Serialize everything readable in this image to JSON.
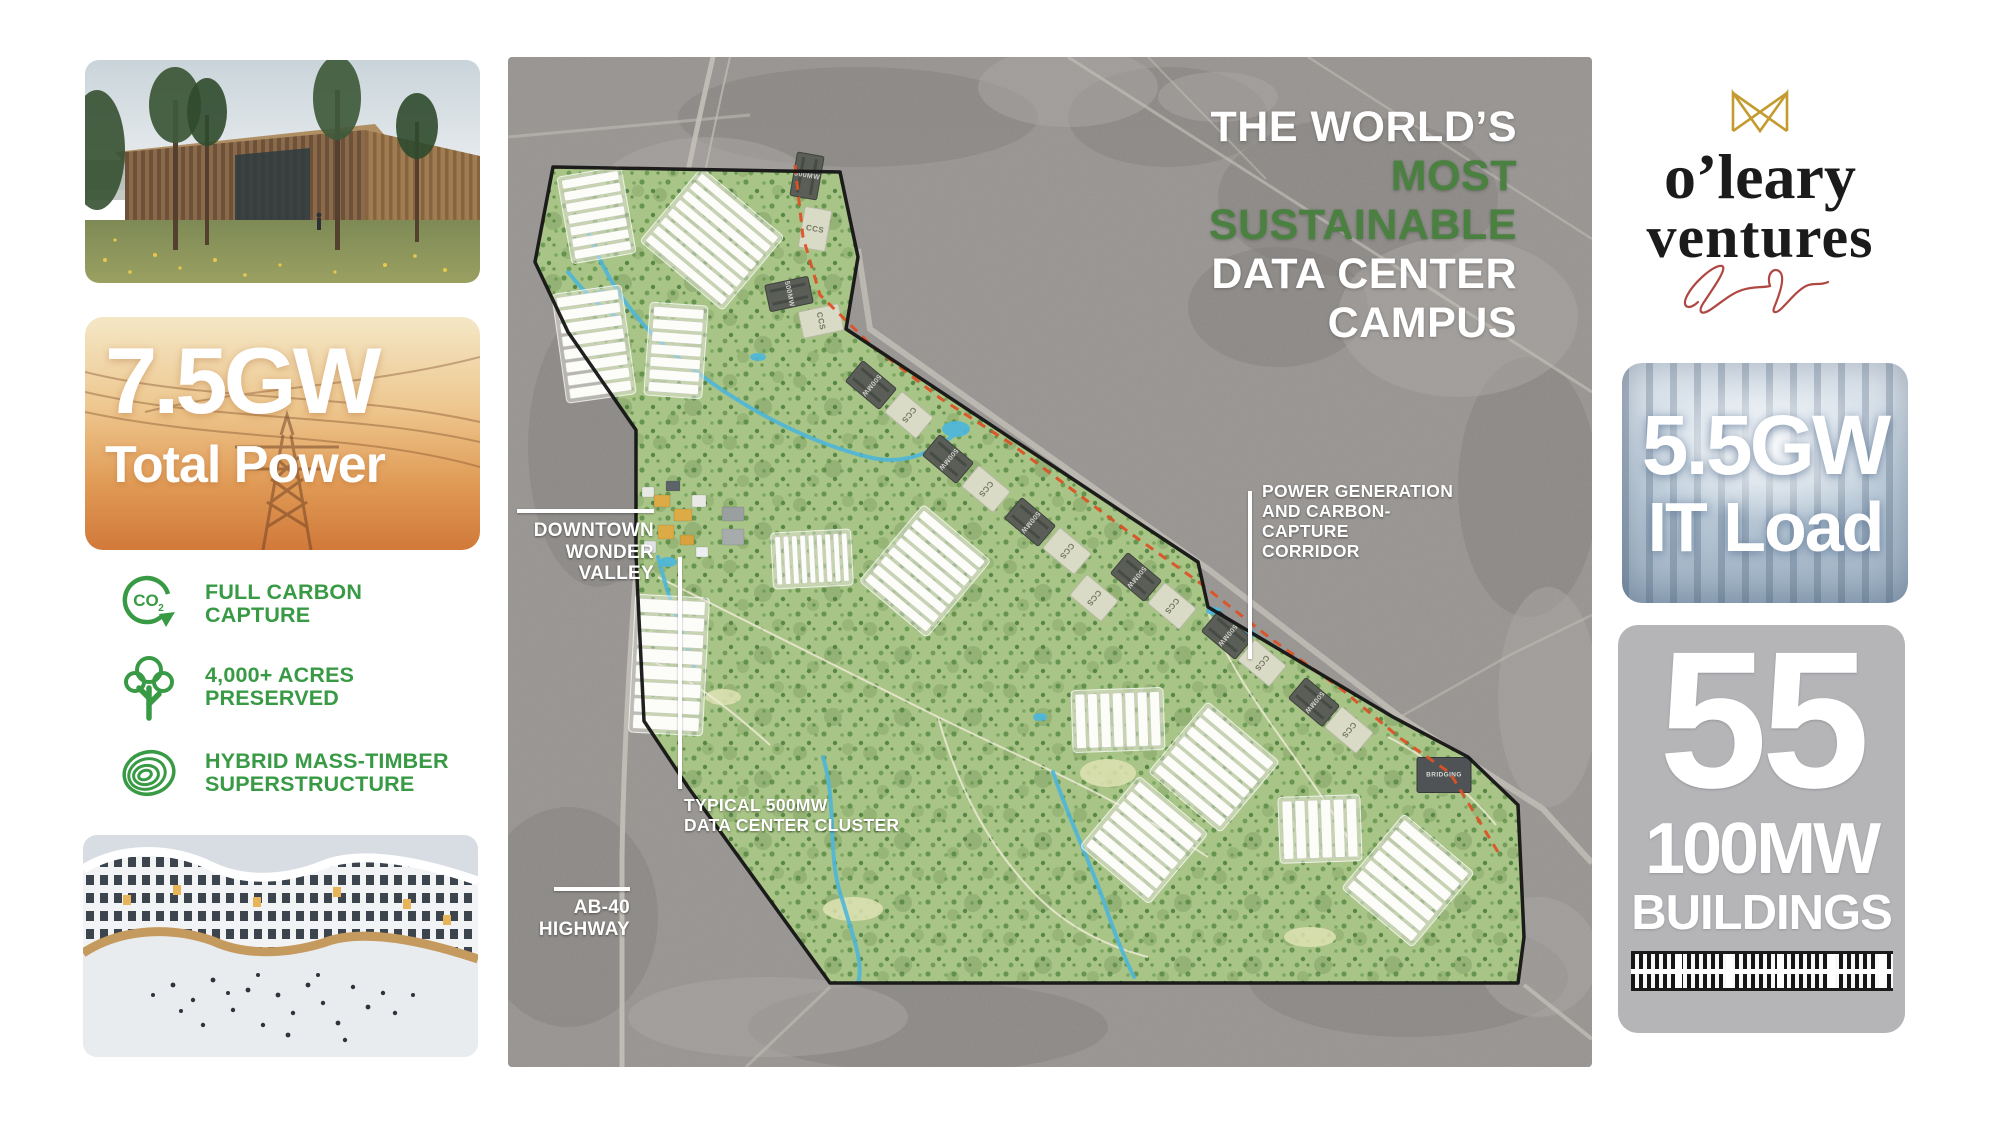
{
  "colors": {
    "title_white": "#ffffff",
    "title_green": "#4a8040",
    "feature_green": "#389a44",
    "map_green": "#a9c487",
    "map_gray": "#908d8a",
    "corridor_red": "#dc5226",
    "campus_outline": "#141414",
    "gold": "#c49b2e",
    "signature_red": "#a93832",
    "buildings_card_gray": "#b5b5b8"
  },
  "left_column": {
    "photo_top": "timber-datacenter-rendering",
    "power_card": {
      "value": "7.5GW",
      "label": "Total Power"
    },
    "features": [
      {
        "icon": "co2-capture-icon",
        "line1": "FULL CARBON",
        "line2": "CAPTURE"
      },
      {
        "icon": "tree-icon",
        "line1": "4,000+ ACRES",
        "line2": "PRESERVED"
      },
      {
        "icon": "timber-rings-icon",
        "line1": "HYBRID MASS-TIMBER",
        "line2": "SUPERSTRUCTURE"
      }
    ],
    "photo_bottom": "winter-plaza-rendering"
  },
  "map": {
    "title": {
      "line1": "THE WORLD’S",
      "line2": "MOST",
      "line3": "SUSTAINABLE",
      "line4": "DATA CENTER",
      "line5": "CAMPUS"
    },
    "labels": {
      "downtown_1": "DOWNTOWN",
      "downtown_2": "WONDER",
      "downtown_3": "VALLEY",
      "cluster_1": "TYPICAL 500MW",
      "cluster_2": "DATA CENTER CLUSTER",
      "highway_1": "AB-40",
      "highway_2": "HIGHWAY",
      "corridor_1": "POWER GENERATION",
      "corridor_2": "AND CARBON-CAPTURE",
      "corridor_3": "CORRIDOR"
    },
    "building_labels": {
      "dark": "500MW",
      "light": "CCS",
      "bridging": "BRIDGING"
    },
    "geo": {
      "polygon": "45,110 332,115 350,200 338,272 690,505 700,550 885,660 960,700 1010,748 1016,880 1010,926 322,926 180,730 136,664 128,500 128,373 60,275 27,205",
      "clusters": [
        {
          "x": 60,
          "y": 118,
          "w": 57,
          "h": 80,
          "rot": -10,
          "bars": 7,
          "dir": "h"
        },
        {
          "x": 55,
          "y": 236,
          "w": 62,
          "h": 102,
          "rot": -8,
          "bars": 8,
          "dir": "h"
        },
        {
          "x": 154,
          "y": 138,
          "w": 100,
          "h": 88,
          "rot": 40,
          "bars": 8,
          "dir": "h"
        },
        {
          "x": 143,
          "y": 251,
          "w": 50,
          "h": 85,
          "rot": 4,
          "bars": 7,
          "dir": "h"
        },
        {
          "x": 268,
          "y": 478,
          "w": 72,
          "h": 48,
          "rot": -3,
          "bars": 9,
          "dir": "v"
        },
        {
          "x": 128,
          "y": 543,
          "w": 66,
          "h": 130,
          "rot": 3,
          "bars": 8,
          "dir": "h"
        },
        {
          "x": 377,
          "y": 468,
          "w": 80,
          "h": 92,
          "rot": 40,
          "bars": 8,
          "dir": "h"
        },
        {
          "x": 568,
          "y": 636,
          "w": 84,
          "h": 54,
          "rot": -2,
          "bars": 7,
          "dir": "v"
        },
        {
          "x": 663,
          "y": 668,
          "w": 86,
          "h": 84,
          "rot": 40,
          "bars": 7,
          "dir": "h"
        },
        {
          "x": 595,
          "y": 741,
          "w": 82,
          "h": 84,
          "rot": 40,
          "bars": 7,
          "dir": "h"
        },
        {
          "x": 775,
          "y": 743,
          "w": 74,
          "h": 58,
          "rot": -2,
          "bars": 6,
          "dir": "v"
        },
        {
          "x": 858,
          "y": 779,
          "w": 84,
          "h": 89,
          "rot": 40,
          "bars": 7,
          "dir": "h"
        }
      ],
      "corridor_path": "M287,108 L295,180 L312,238 L362,287 L432,341 L502,386 L562,431 L622,476 L692,526 L762,581 L832,631 L892,681 L942,716 L990,795",
      "buildings": [
        {
          "cx": 299,
          "cy": 119,
          "rot": -80,
          "type": "dark"
        },
        {
          "cx": 307,
          "cy": 172,
          "rot": -80,
          "type": "light"
        },
        {
          "cx": 281,
          "cy": 237,
          "rot": -12,
          "type": "dark"
        },
        {
          "cx": 313,
          "cy": 264,
          "rot": -12,
          "type": "light"
        },
        {
          "cx": 363,
          "cy": 328,
          "rot": 40,
          "type": "dark"
        },
        {
          "cx": 401,
          "cy": 358,
          "rot": 40,
          "type": "light"
        },
        {
          "cx": 440,
          "cy": 402,
          "rot": 40,
          "type": "dark"
        },
        {
          "cx": 478,
          "cy": 432,
          "rot": 40,
          "type": "light"
        },
        {
          "cx": 522,
          "cy": 465,
          "rot": 40,
          "type": "dark"
        },
        {
          "cx": 559,
          "cy": 494,
          "rot": 40,
          "type": "light"
        },
        {
          "cx": 586,
          "cy": 541,
          "rot": 40,
          "type": "light"
        },
        {
          "cx": 628,
          "cy": 520,
          "rot": 40,
          "type": "dark"
        },
        {
          "cx": 664,
          "cy": 549,
          "rot": 40,
          "type": "light"
        },
        {
          "cx": 719,
          "cy": 578,
          "rot": 40,
          "type": "dark"
        },
        {
          "cx": 754,
          "cy": 606,
          "rot": 40,
          "type": "light"
        },
        {
          "cx": 806,
          "cy": 645,
          "rot": 40,
          "type": "dark"
        },
        {
          "cx": 841,
          "cy": 673,
          "rot": 40,
          "type": "light"
        },
        {
          "cx": 936,
          "cy": 718,
          "rot": 0,
          "type": "bridging"
        }
      ],
      "streams": [
        "M78,170 C95,215 120,260 170,300 C230,350 300,385 360,400 C400,410 428,392 446,378",
        "M315,700 C330,750 318,800 335,845 C345,880 356,906 350,926",
        "M545,715 C560,760 580,800 596,845 C606,875 616,900 626,920",
        "M150,500 C160,540 174,575 186,610",
        "M60,215 C80,240 95,252 112,262"
      ],
      "ponds": [
        [
          448,
          372,
          14,
          8
        ],
        [
          95,
          238,
          9,
          5
        ],
        [
          160,
          505,
          9,
          5
        ],
        [
          250,
          300,
          8,
          4
        ],
        [
          706,
          554,
          8,
          4
        ],
        [
          742,
          577,
          6,
          4
        ],
        [
          532,
          660,
          7,
          4
        ]
      ],
      "meadows": [
        [
          600,
          716,
          28,
          14
        ],
        [
          345,
          852,
          30,
          12
        ],
        [
          802,
          880,
          26,
          10
        ],
        [
          215,
          640,
          18,
          8
        ]
      ],
      "trails": [
        "M150,520 C240,565 330,610 420,655 C510,700 600,735 700,800",
        "M700,555 C720,610 758,660 790,705 C810,735 830,760 850,800",
        "M430,660 C450,730 480,790 530,840 C560,870 600,890 640,900",
        "M136,600 C180,620 220,650 262,688",
        "M880,680 C920,700 958,732 988,768"
      ],
      "roads": [
        {
          "d": "M205,0 C175,130 148,270 140,370 C132,460 117,620 114,800 L114,1010",
          "w": 5,
          "o": 0.9
        },
        {
          "d": "M222,0 C192,130 166,270 158,370",
          "w": 2,
          "o": 0.7
        },
        {
          "d": "M350,192 L362,272 L700,512 L892,660 L1035,752 L1084,806",
          "w": 6,
          "o": 0.8
        },
        {
          "d": "M560,0 L1084,335",
          "w": 3,
          "o": 0.65
        },
        {
          "d": "M800,0 L1084,182",
          "w": 2.5,
          "o": 0.55
        },
        {
          "d": "M640,0 L758,122",
          "w": 2,
          "o": 0.5
        },
        {
          "d": "M1016,928 L1084,982",
          "w": 4,
          "o": 0.75
        },
        {
          "d": "M322,930 L238,1010",
          "w": 3,
          "o": 0.55
        },
        {
          "d": "M0,80 L242,58",
          "w": 3,
          "o": 0.55
        },
        {
          "d": "M892,660 L1002,598 L1084,558",
          "w": 2.5,
          "o": 0.5
        }
      ],
      "patches_dark": [
        [
          350,
          60,
          180,
          50
        ],
        [
          90,
          390,
          70,
          140
        ],
        [
          850,
          140,
          140,
          80
        ],
        [
          1020,
          430,
          70,
          130
        ],
        [
          900,
          920,
          160,
          60
        ],
        [
          420,
          970,
          180,
          45
        ],
        [
          60,
          860,
          90,
          110
        ],
        [
          660,
          60,
          100,
          50
        ],
        [
          770,
          250,
          90,
          60
        ]
      ],
      "patches_light": [
        [
          200,
          150,
          120,
          70
        ],
        [
          950,
          260,
          120,
          80
        ],
        [
          1040,
          640,
          50,
          110
        ],
        [
          260,
          960,
          140,
          40
        ],
        [
          1030,
          900,
          60,
          60
        ],
        [
          560,
          30,
          90,
          40
        ],
        [
          710,
          40,
          60,
          25
        ]
      ],
      "downtown_blocks": [
        [
          146,
          438,
          16,
          12,
          "#dcab45"
        ],
        [
          166,
          452,
          18,
          12,
          "#dcab45"
        ],
        [
          150,
          468,
          16,
          14,
          "#dcab45"
        ],
        [
          172,
          478,
          14,
          10,
          "#d8a33f"
        ],
        [
          134,
          430,
          12,
          10,
          "#e8e8e4"
        ],
        [
          184,
          438,
          14,
          12,
          "#e8e8e4"
        ],
        [
          136,
          484,
          12,
          12,
          "#dfe3e4"
        ],
        [
          188,
          490,
          12,
          10,
          "#eceff0"
        ],
        [
          158,
          424,
          14,
          10,
          "#5c6468"
        ],
        [
          214,
          450,
          22,
          14,
          "#9aa0a0"
        ],
        [
          214,
          472,
          22,
          16,
          "#a6acac"
        ]
      ]
    }
  },
  "right_column": {
    "logo": {
      "line1": "o’leary",
      "line2": "ventures"
    },
    "it_card": {
      "value": "5.5GW",
      "label": "IT Load"
    },
    "buildings_card": {
      "value": "55",
      "capacity": "100MW",
      "label": "BUILDINGS"
    }
  }
}
